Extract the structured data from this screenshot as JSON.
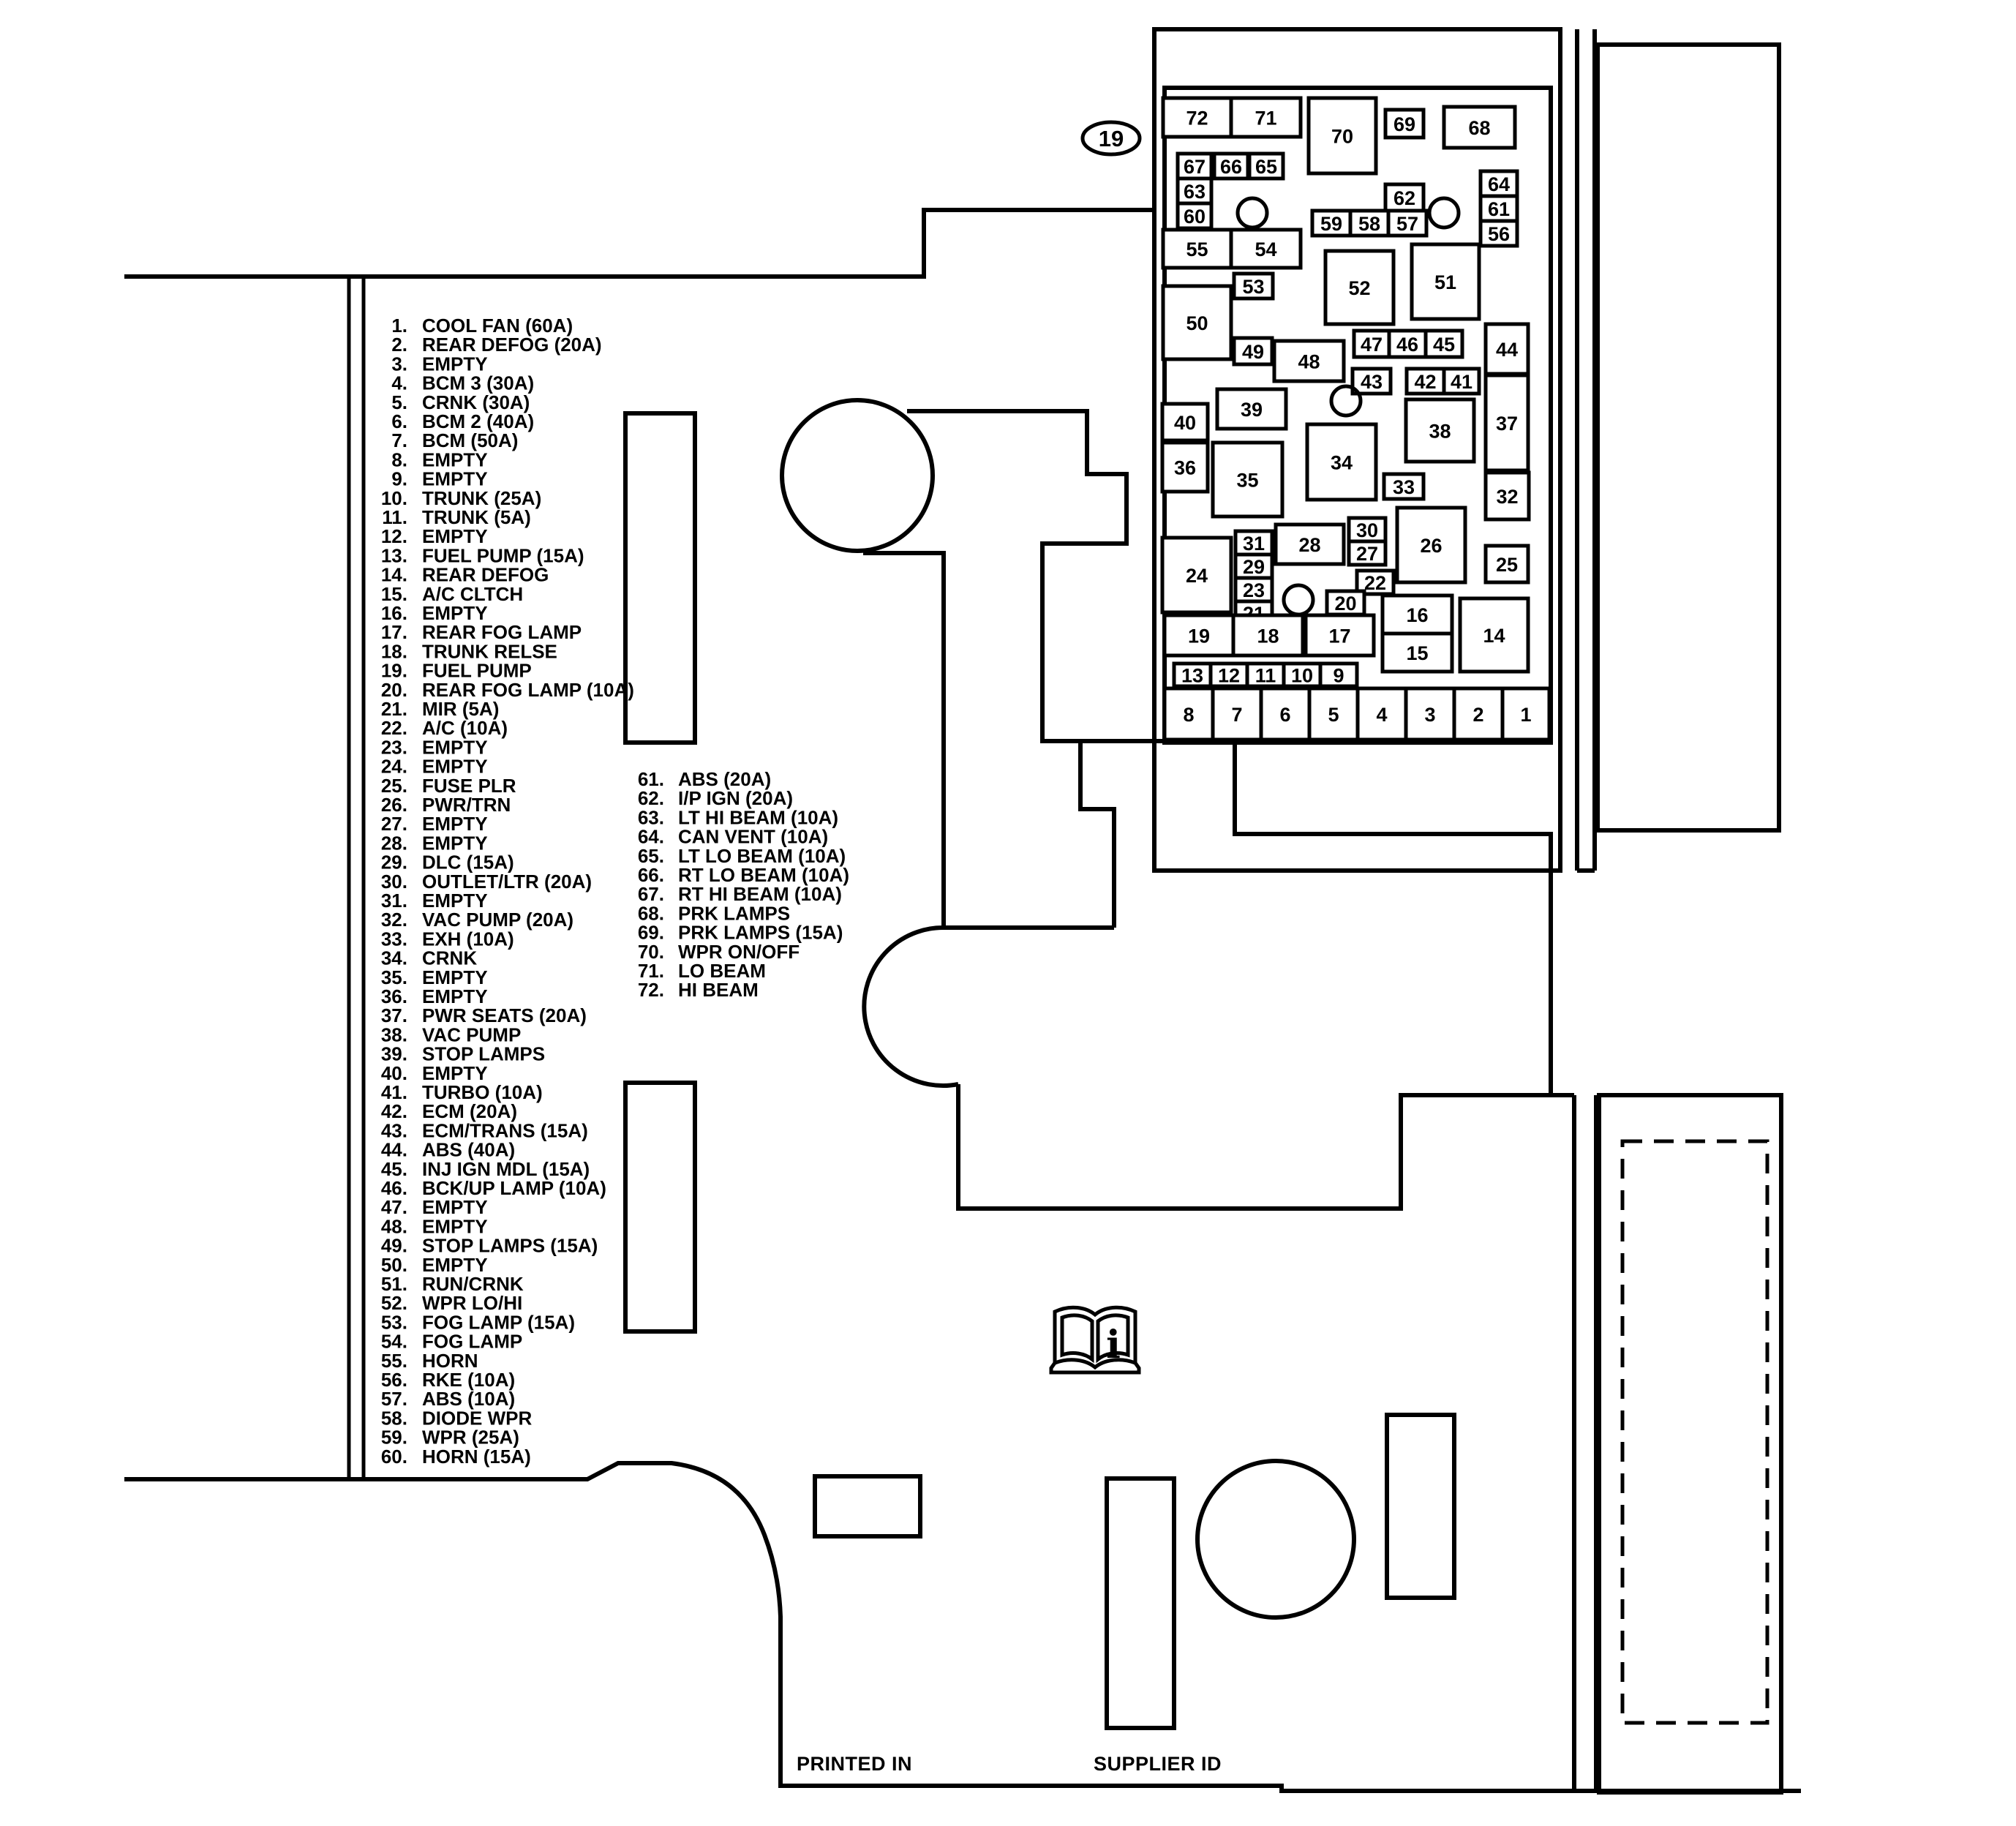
{
  "figure": {
    "callout": "19",
    "printed_in": "PRINTED IN",
    "supplier_id": "SUPPLIER ID",
    "info_glyph": "i"
  },
  "legend_col1": [
    {
      "n": "1.",
      "label": "COOL FAN (60A)"
    },
    {
      "n": "2.",
      "label": "REAR DEFOG (20A)"
    },
    {
      "n": "3.",
      "label": "EMPTY"
    },
    {
      "n": "4.",
      "label": "BCM 3 (30A)"
    },
    {
      "n": "5.",
      "label": "CRNK (30A)"
    },
    {
      "n": "6.",
      "label": "BCM 2 (40A)"
    },
    {
      "n": "7.",
      "label": "BCM (50A)"
    },
    {
      "n": "8.",
      "label": "EMPTY"
    },
    {
      "n": "9.",
      "label": "EMPTY"
    },
    {
      "n": "10.",
      "label": "TRUNK (25A)"
    },
    {
      "n": "11.",
      "label": "TRUNK (5A)"
    },
    {
      "n": "12.",
      "label": "EMPTY"
    },
    {
      "n": "13.",
      "label": "FUEL PUMP (15A)"
    },
    {
      "n": "14.",
      "label": "REAR DEFOG"
    },
    {
      "n": "15.",
      "label": "A/C CLTCH"
    },
    {
      "n": "16.",
      "label": "EMPTY"
    },
    {
      "n": "17.",
      "label": "REAR FOG LAMP"
    },
    {
      "n": "18.",
      "label": "TRUNK RELSE"
    },
    {
      "n": "19.",
      "label": "FUEL PUMP"
    },
    {
      "n": "20.",
      "label": "REAR FOG LAMP (10A)"
    },
    {
      "n": "21.",
      "label": "MIR (5A)"
    },
    {
      "n": "22.",
      "label": "A/C (10A)"
    },
    {
      "n": "23.",
      "label": "EMPTY"
    },
    {
      "n": "24.",
      "label": "EMPTY"
    },
    {
      "n": "25.",
      "label": "FUSE PLR"
    },
    {
      "n": "26.",
      "label": "PWR/TRN"
    },
    {
      "n": "27.",
      "label": "EMPTY"
    },
    {
      "n": "28.",
      "label": "EMPTY"
    },
    {
      "n": "29.",
      "label": "DLC (15A)"
    },
    {
      "n": "30.",
      "label": "OUTLET/LTR (20A)"
    },
    {
      "n": "31.",
      "label": "EMPTY"
    },
    {
      "n": "32.",
      "label": "VAC PUMP (20A)"
    },
    {
      "n": "33.",
      "label": "EXH (10A)"
    },
    {
      "n": "34.",
      "label": "CRNK"
    },
    {
      "n": "35.",
      "label": "EMPTY"
    },
    {
      "n": "36.",
      "label": "EMPTY"
    },
    {
      "n": "37.",
      "label": "PWR SEATS (20A)"
    },
    {
      "n": "38.",
      "label": "VAC PUMP"
    },
    {
      "n": "39.",
      "label": "STOP LAMPS"
    },
    {
      "n": "40.",
      "label": "EMPTY"
    },
    {
      "n": "41.",
      "label": "TURBO (10A)"
    },
    {
      "n": "42.",
      "label": "ECM (20A)"
    },
    {
      "n": "43.",
      "label": "ECM/TRANS (15A)"
    },
    {
      "n": "44.",
      "label": "ABS (40A)"
    },
    {
      "n": "45.",
      "label": "INJ IGN MDL (15A)"
    },
    {
      "n": "46.",
      "label": "BCK/UP LAMP (10A)"
    },
    {
      "n": "47.",
      "label": "EMPTY"
    },
    {
      "n": "48.",
      "label": "EMPTY"
    },
    {
      "n": "49.",
      "label": "STOP LAMPS (15A)"
    },
    {
      "n": "50.",
      "label": "EMPTY"
    },
    {
      "n": "51.",
      "label": "RUN/CRNK"
    },
    {
      "n": "52.",
      "label": "WPR LO/HI"
    },
    {
      "n": "53.",
      "label": "FOG LAMP (15A)"
    },
    {
      "n": "54.",
      "label": "FOG LAMP"
    },
    {
      "n": "55.",
      "label": "HORN"
    },
    {
      "n": "56.",
      "label": "RKE (10A)"
    },
    {
      "n": "57.",
      "label": "ABS (10A)"
    },
    {
      "n": "58.",
      "label": "DIODE WPR"
    },
    {
      "n": "59.",
      "label": "WPR (25A)"
    },
    {
      "n": "60.",
      "label": "HORN (15A)"
    }
  ],
  "legend_col2": [
    {
      "n": "61.",
      "label": "ABS (20A)"
    },
    {
      "n": "62.",
      "label": "I/P IGN (20A)"
    },
    {
      "n": "63.",
      "label": "LT HI BEAM (10A)"
    },
    {
      "n": "64.",
      "label": "CAN VENT (10A)"
    },
    {
      "n": "65.",
      "label": "LT LO BEAM (10A)"
    },
    {
      "n": "66.",
      "label": "RT LO BEAM (10A)"
    },
    {
      "n": "67.",
      "label": "RT HI BEAM (10A)"
    },
    {
      "n": "68.",
      "label": "PRK LAMPS"
    },
    {
      "n": "69.",
      "label": "PRK LAMPS (15A)"
    },
    {
      "n": "70.",
      "label": "WPR ON/OFF"
    },
    {
      "n": "71.",
      "label": "LO BEAM"
    },
    {
      "n": "72.",
      "label": "HI BEAM"
    }
  ],
  "fusebox": {
    "cells": [
      "72",
      "71",
      "70",
      "69",
      "68",
      "67",
      "66",
      "65",
      "63",
      "60",
      "62",
      "59",
      "58",
      "57",
      "64",
      "61",
      "56",
      "55",
      "54",
      "53",
      "52",
      "51",
      "50",
      "49",
      "48",
      "47",
      "46",
      "45",
      "44",
      "43",
      "42",
      "41",
      "40",
      "39",
      "38",
      "37",
      "36",
      "35",
      "34",
      "33",
      "32",
      "31",
      "29",
      "23",
      "21",
      "28",
      "30",
      "27",
      "26",
      "24",
      "25",
      "22",
      "20",
      "16",
      "15",
      "14",
      "19",
      "18",
      "17",
      "13",
      "12",
      "11",
      "10",
      "9",
      "8",
      "7",
      "6",
      "5",
      "4",
      "3",
      "2",
      "1"
    ]
  },
  "colors": {
    "line": "#000000",
    "background": "#ffffff"
  }
}
